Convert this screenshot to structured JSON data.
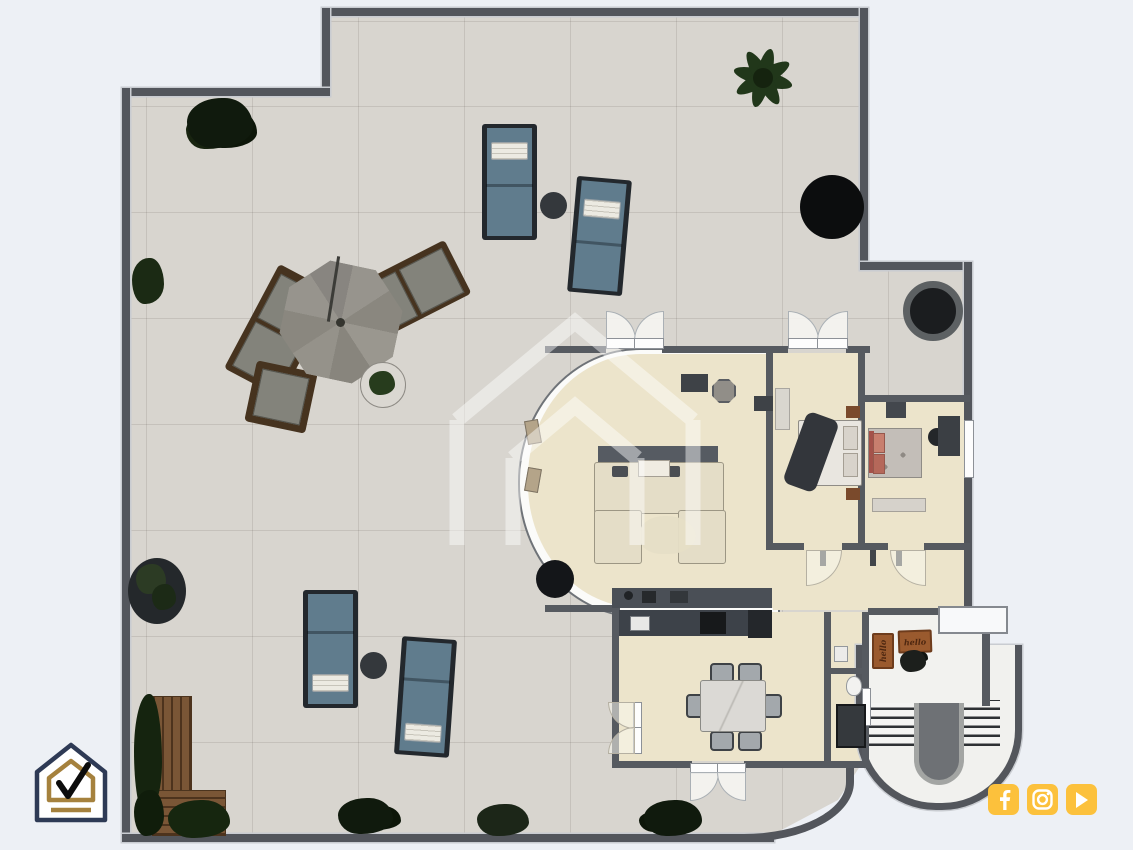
{
  "doormats": [
    {
      "text": "hello"
    },
    {
      "text": "hello"
    }
  ],
  "social_icons": [
    {
      "name": "facebook"
    },
    {
      "name": "instagram"
    },
    {
      "name": "youtube"
    }
  ],
  "branding": {
    "corner_logo": "house-check-logo",
    "watermark": "house-outline-watermark"
  },
  "colors": {
    "page_background": "#edf0f5",
    "terrace_floor": "#d8d5cf",
    "exterior_wall": "#53565c",
    "interior_floor": "#ece4cb",
    "entry_floor": "#f2f2ef",
    "lounger_cushion": "#607c8d",
    "doormat_brown": "#9a5a2e",
    "social_gold": "#fcc13c",
    "logo_navy": "#2e3a55",
    "logo_gold": "#a5813d"
  }
}
